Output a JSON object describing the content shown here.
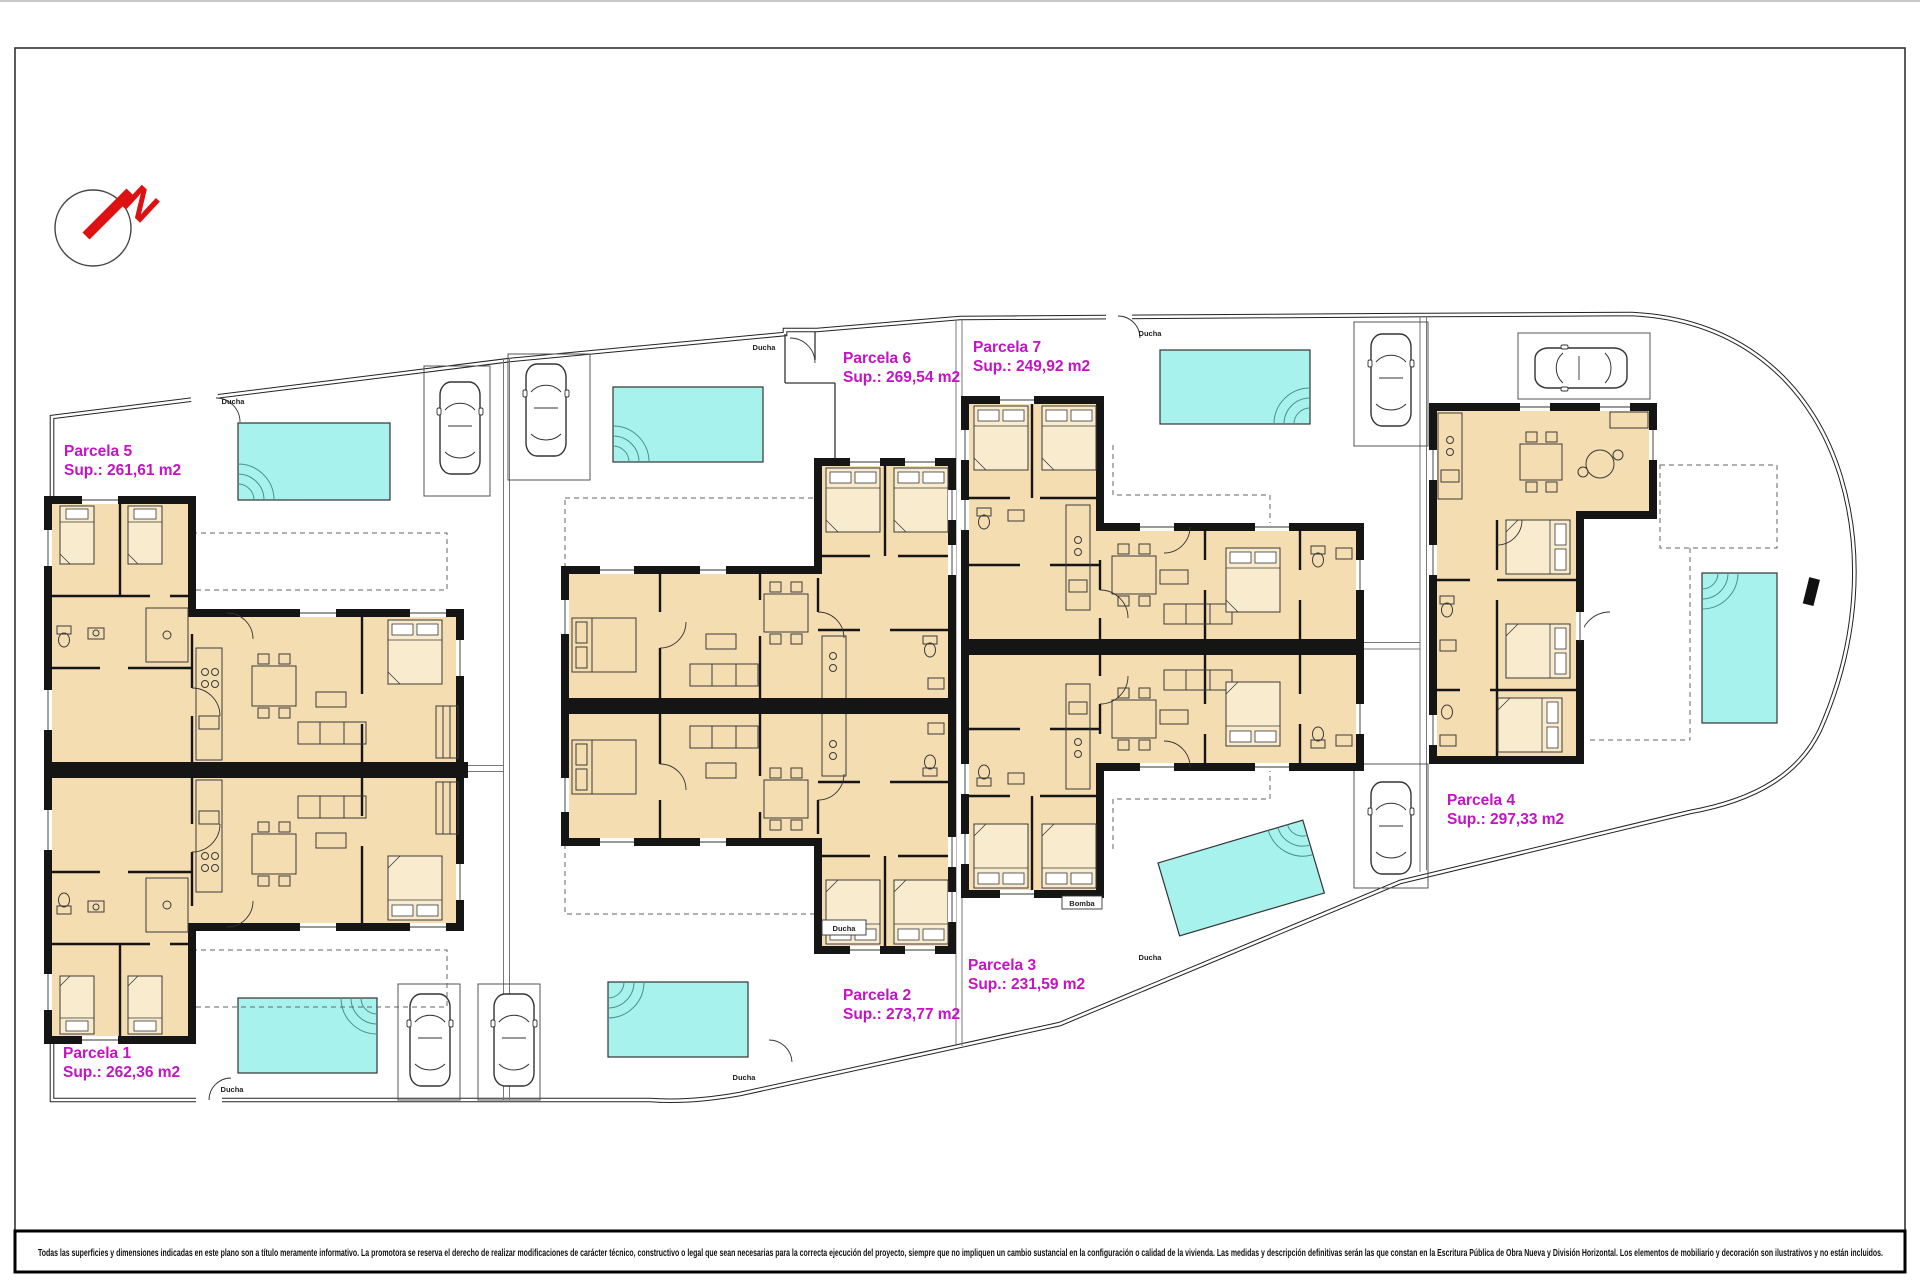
{
  "document": {
    "type": "architectural-site-plan",
    "north_label": "N",
    "parcels": [
      {
        "name": "Parcela 1",
        "area": "Sup.: 262,36 m2"
      },
      {
        "name": "Parcela 2",
        "area": "Sup.: 273,77 m2"
      },
      {
        "name": "Parcela 3",
        "area": "Sup.: 231,59 m2"
      },
      {
        "name": "Parcela 4",
        "area": "Sup.: 297,33 m2"
      },
      {
        "name": "Parcela 5",
        "area": "Sup.: 261,61 m2"
      },
      {
        "name": "Parcela 6",
        "area": "Sup.: 269,54 m2"
      },
      {
        "name": "Parcela 7",
        "area": "Sup.: 249,92 m2"
      }
    ],
    "site_labels": {
      "ducha": "Ducha",
      "bomba": "Bomba"
    },
    "disclaimer": "Todas las superficies y dimensiones indicadas en este plano son a título meramente informativo. La promotora se reserva el derecho de realizar modificaciones de carácter técnico, constructivo o legal que sean necesarias para la correcta ejecución del proyecto, siempre que no impliquen un cambio sustancial en la configuración o calidad de la vivienda. Las medidas y descripción definitivas serán las que constan en la Escritura Pública de Obra Nueva y División Horizontal. Los elementos de mobiliario y decoración son ilustrativos y no están incluidos.",
    "colors": {
      "room_fill": "#F5DDB2",
      "pool_fill": "#A8F2ED",
      "label_magenta": "#C412C4",
      "wall_black": "#151515",
      "north_red": "#DD1111"
    }
  }
}
